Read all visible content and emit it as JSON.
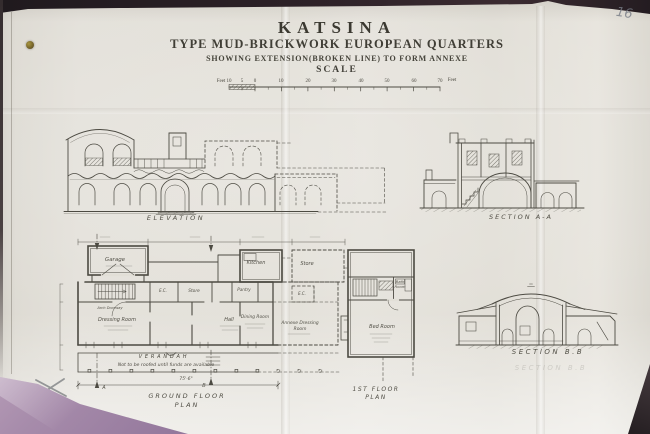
{
  "photo": {
    "page_annotation": "16"
  },
  "title_block": {
    "title": "KATSINA",
    "subtitle": "TYPE MUD-BRICKWORK EUROPEAN QUARTERS",
    "subnote": "SHOWING EXTENSION(BROKEN LINE) TO FORM ANNEXE",
    "scale_heading": "SCALE",
    "scale": {
      "left_unit": "Feet",
      "right_unit": "Feet",
      "ticks": [
        "10",
        "5",
        "0",
        "10",
        "20",
        "30",
        "40",
        "50",
        "60",
        "70"
      ]
    }
  },
  "drawings": {
    "elevation": {
      "caption": "ELEVATION"
    },
    "section_aa": {
      "caption": "SECTION A-A"
    },
    "section_bb": {
      "caption": "SECTION B.B",
      "caption_ghost": "SECTION B.B"
    },
    "ground_floor_plan": {
      "caption_line1": "GROUND FLOOR",
      "caption_line2": "PLAN",
      "rooms": {
        "garage": "Garage",
        "kitchen": "Kitchen",
        "store_annexe": "Store",
        "store": "Store",
        "pantry": "Pantry",
        "ec_1": "E.C.",
        "ec_2": "E.C.",
        "dressing_room": "Dressing Room",
        "hall": "Hall",
        "dining_room": "Dining Room",
        "annexe_dressing_line1": "Annexe Dressing",
        "annexe_dressing_line2": "Room",
        "arch_doorway": "Arch Doorway",
        "verandah": "VERANDAH"
      },
      "note": "Not to be roofed until funds are available",
      "dimension_overall": "75'-6\"",
      "section_marker_a": "A",
      "section_marker_b": "B"
    },
    "first_floor_plan": {
      "caption_line1": "1ST FLOOR",
      "caption_line2": "PLAN",
      "rooms": {
        "bath_line1": "Bath",
        "bath_line2": "Room",
        "bed": "Bed Room"
      }
    }
  },
  "colors": {
    "paper": "#e0ddd5",
    "ink": "#4c4a42",
    "book_edge": "#241c20",
    "cover_purple": "#a78cab",
    "pencil": "#767b85"
  }
}
